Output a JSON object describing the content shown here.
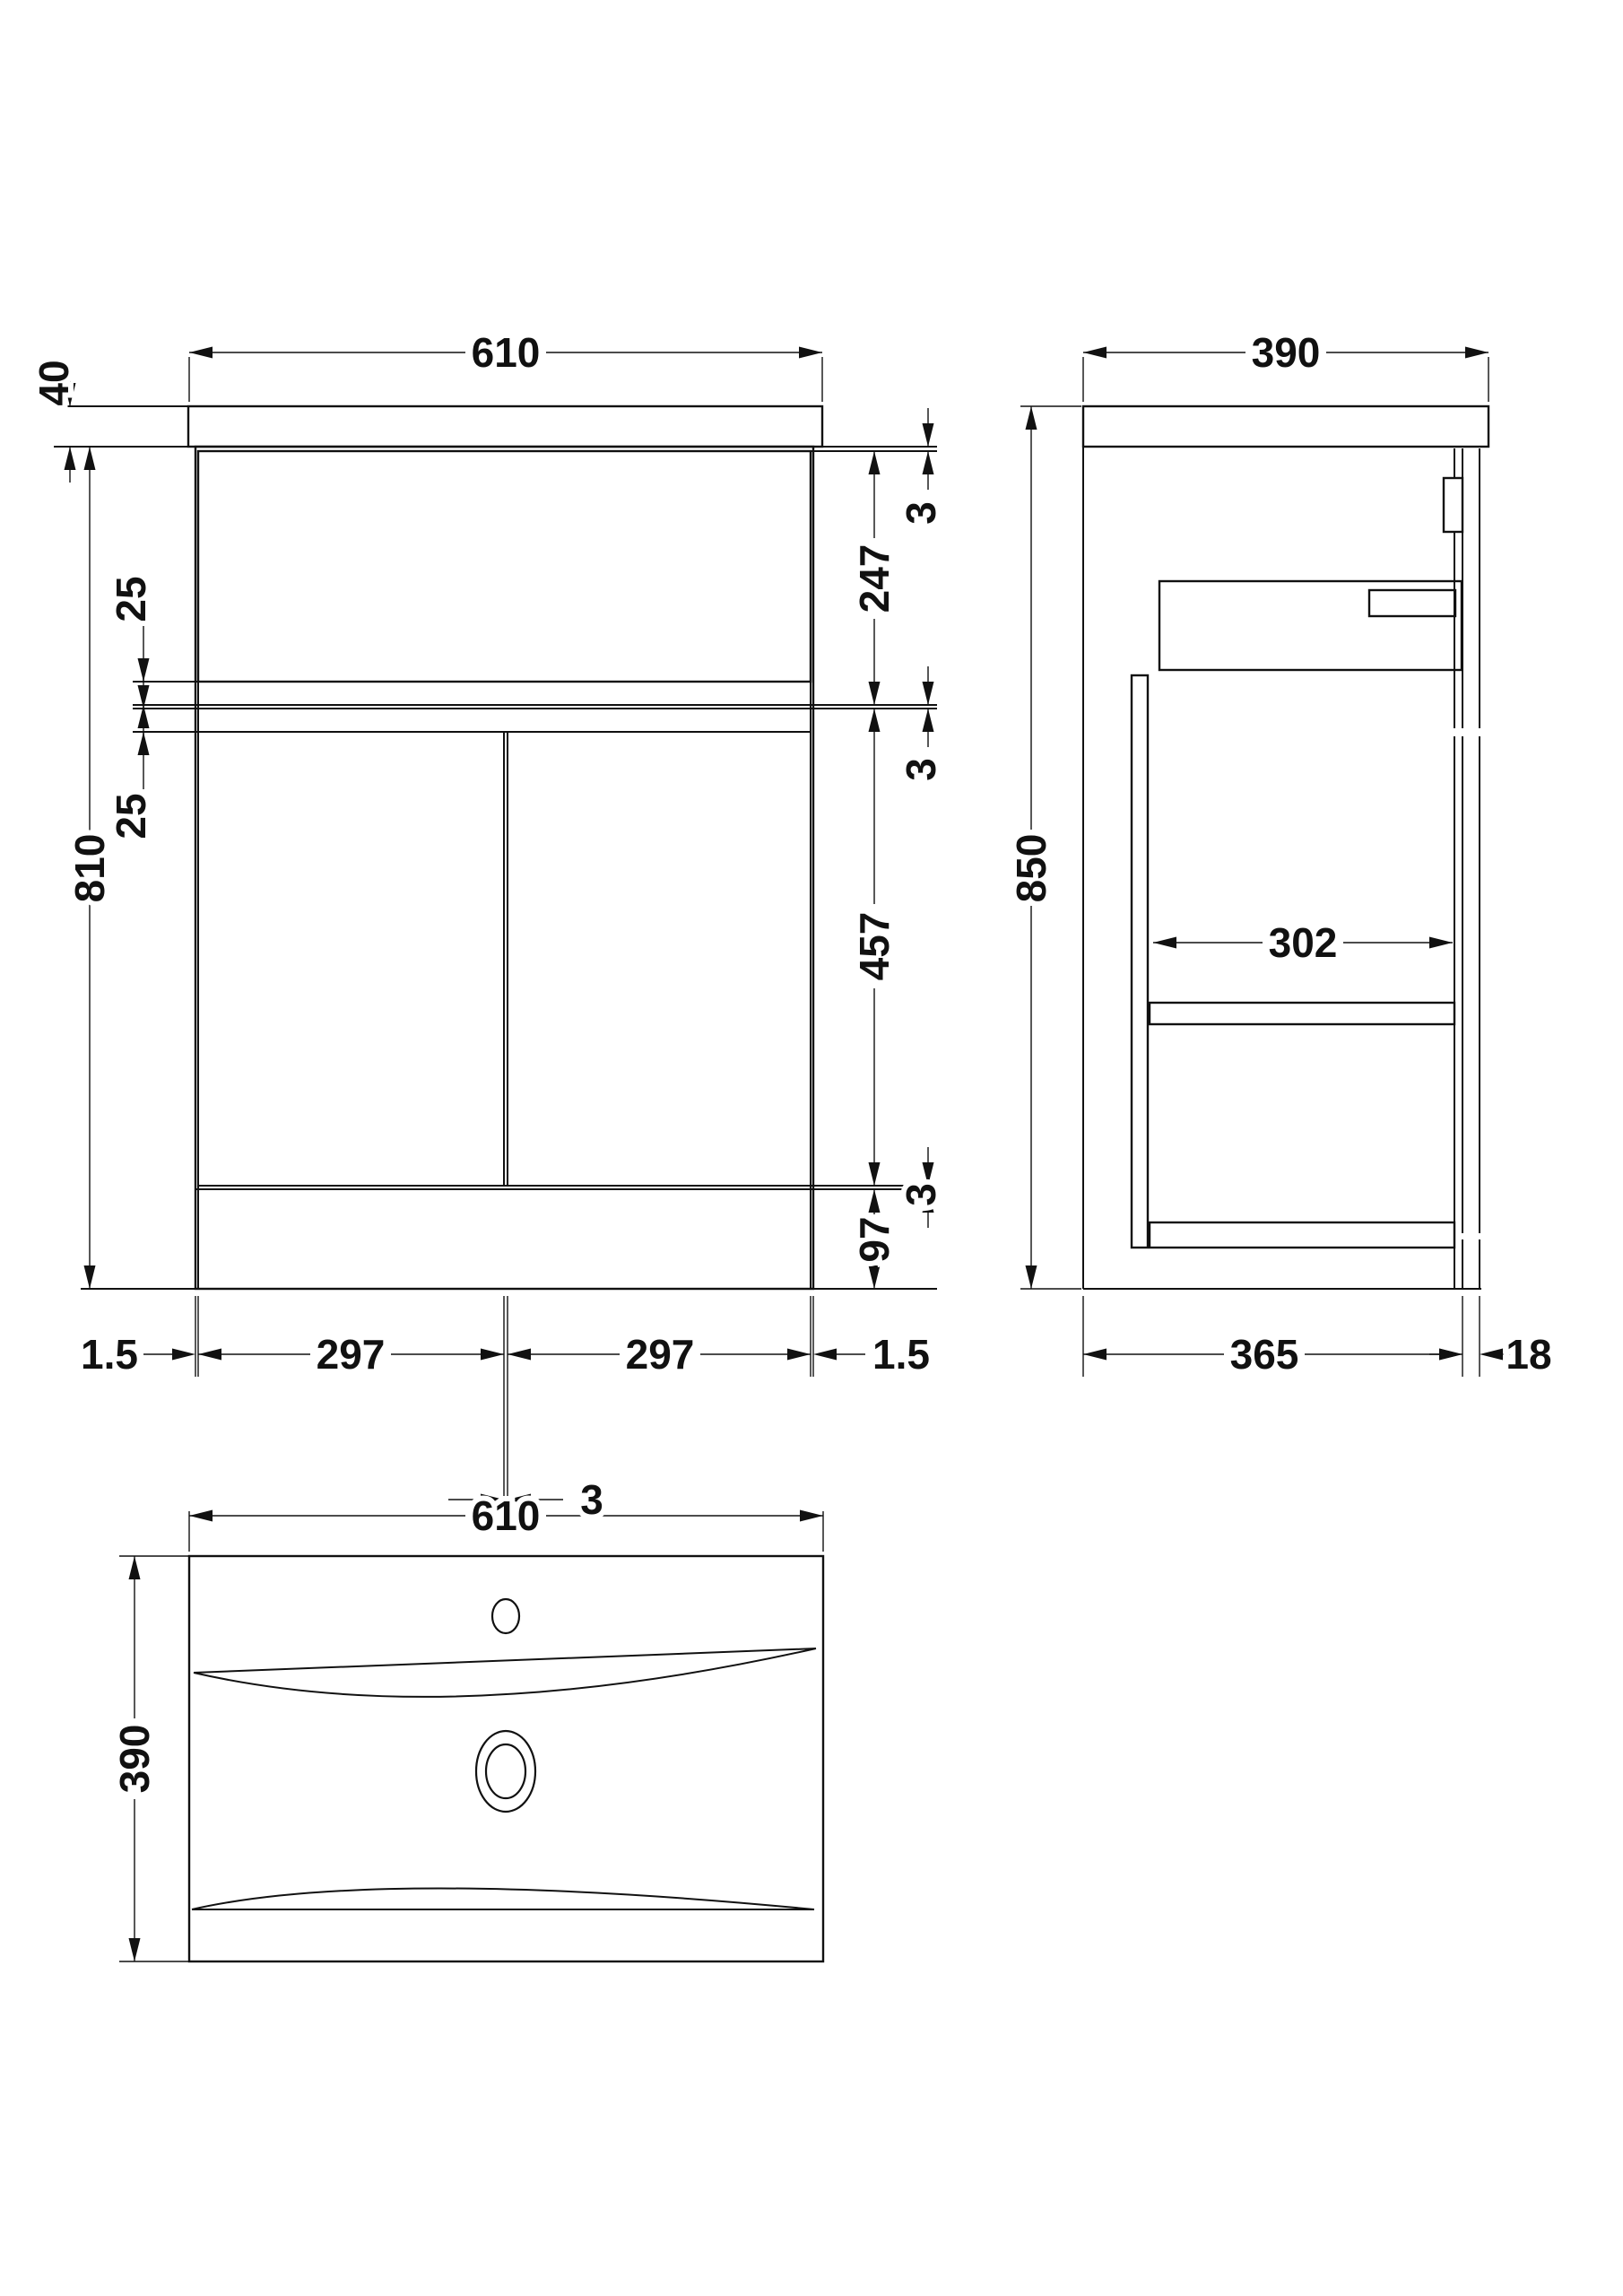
{
  "drawing": {
    "front": {
      "width": "610",
      "worktop_thickness": "40",
      "cabinet_height": "810",
      "drawer_overlap": "25",
      "door_overlap": "25",
      "gap_top": "3",
      "drawer_height": "247",
      "gap_middle": "3",
      "door_height": "457",
      "gap_bottom": "3",
      "plinth_height": "97",
      "edge_gap_left": "1.5",
      "door_width_left": "297",
      "center_gap": "3",
      "door_width_right": "297",
      "edge_gap_right": "1.5"
    },
    "side": {
      "depth": "390",
      "total_height": "850",
      "internal_depth": "302",
      "body_depth": "365",
      "back_gap": "18"
    },
    "plan": {
      "width": "610",
      "depth": "390"
    }
  }
}
